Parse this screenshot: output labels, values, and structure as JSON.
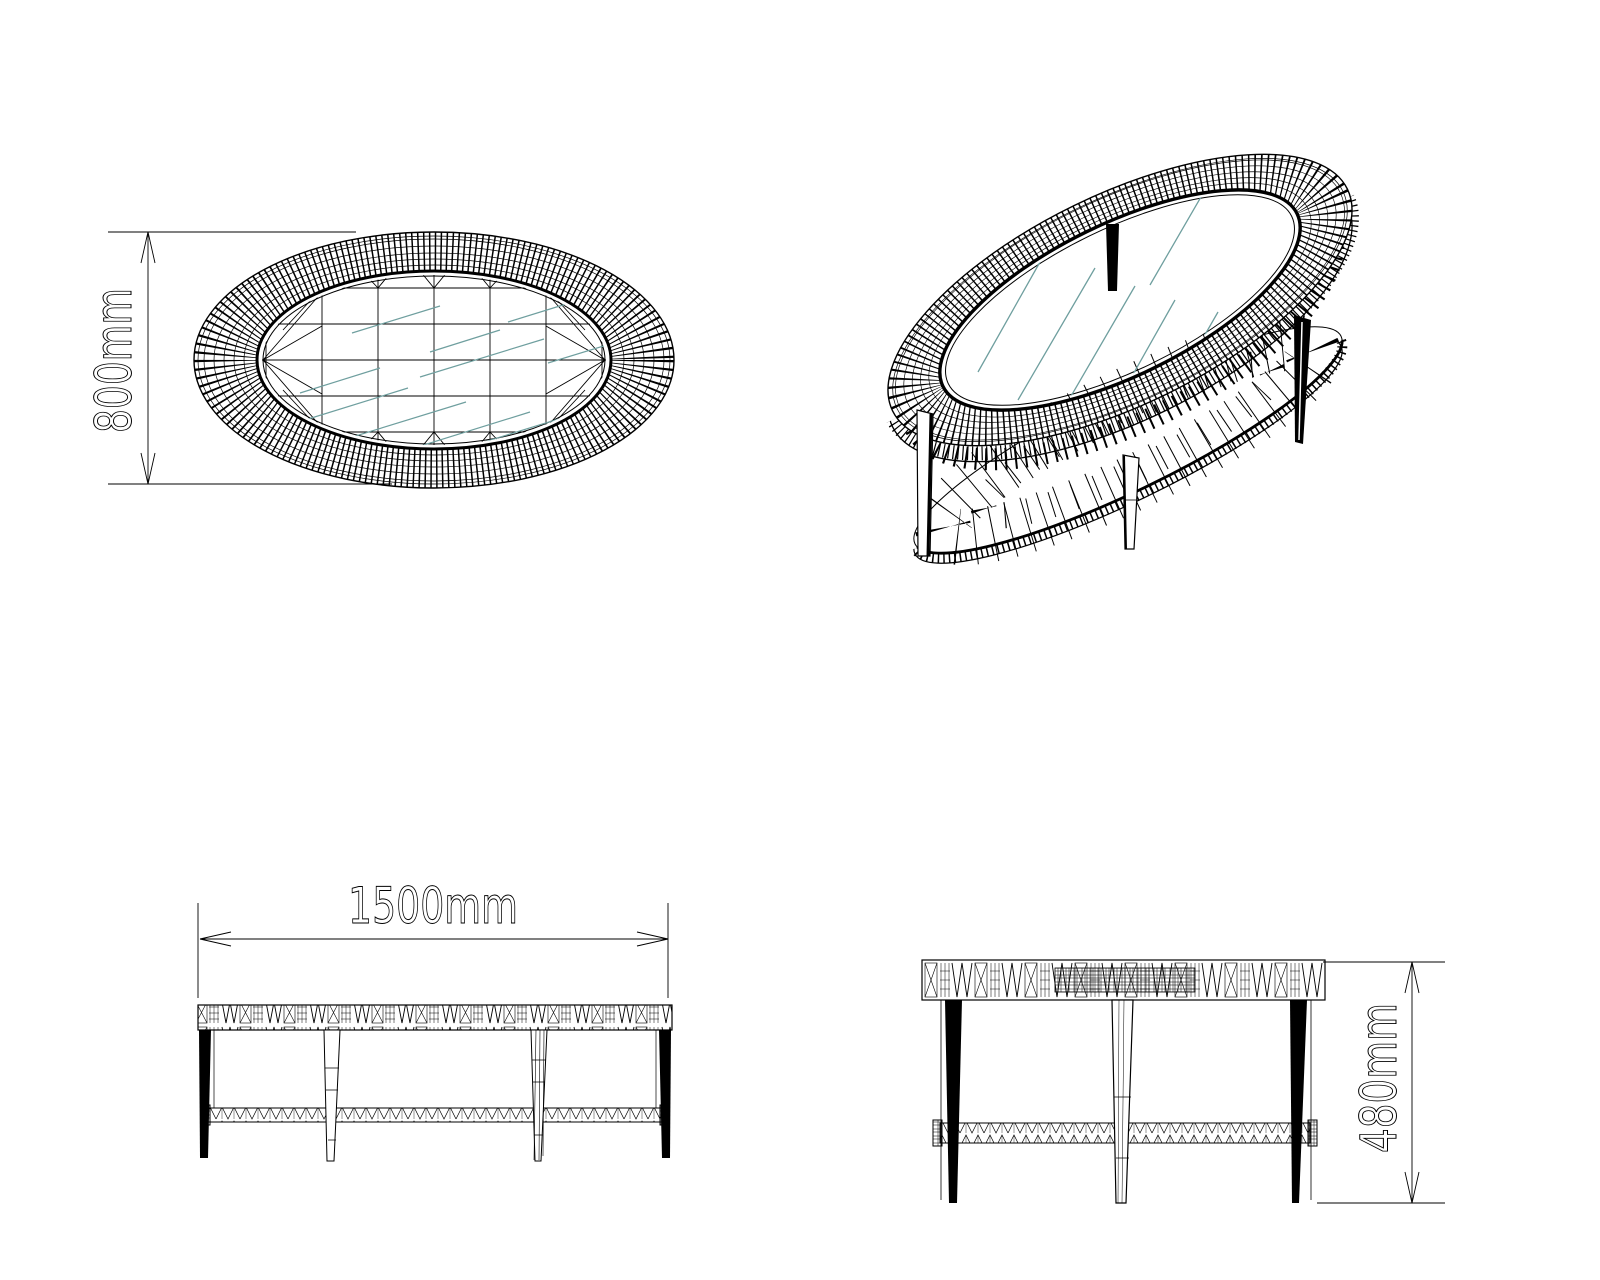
{
  "drawing": {
    "colors": {
      "background": "#ffffff",
      "line": "#000000",
      "glass_hatch": "#6f9f9f"
    },
    "views": {
      "top_view": {
        "dimension_label": "800mm",
        "dimension_value": 800,
        "unit": "mm",
        "orientation": "vertical"
      },
      "front_view": {
        "dimension_label": "1500mm",
        "dimension_value": 1500,
        "unit": "mm",
        "orientation": "horizontal"
      },
      "side_view": {
        "dimension_label": "480mm",
        "dimension_value": 480,
        "unit": "mm",
        "orientation": "vertical"
      },
      "isometric_view": {}
    }
  }
}
